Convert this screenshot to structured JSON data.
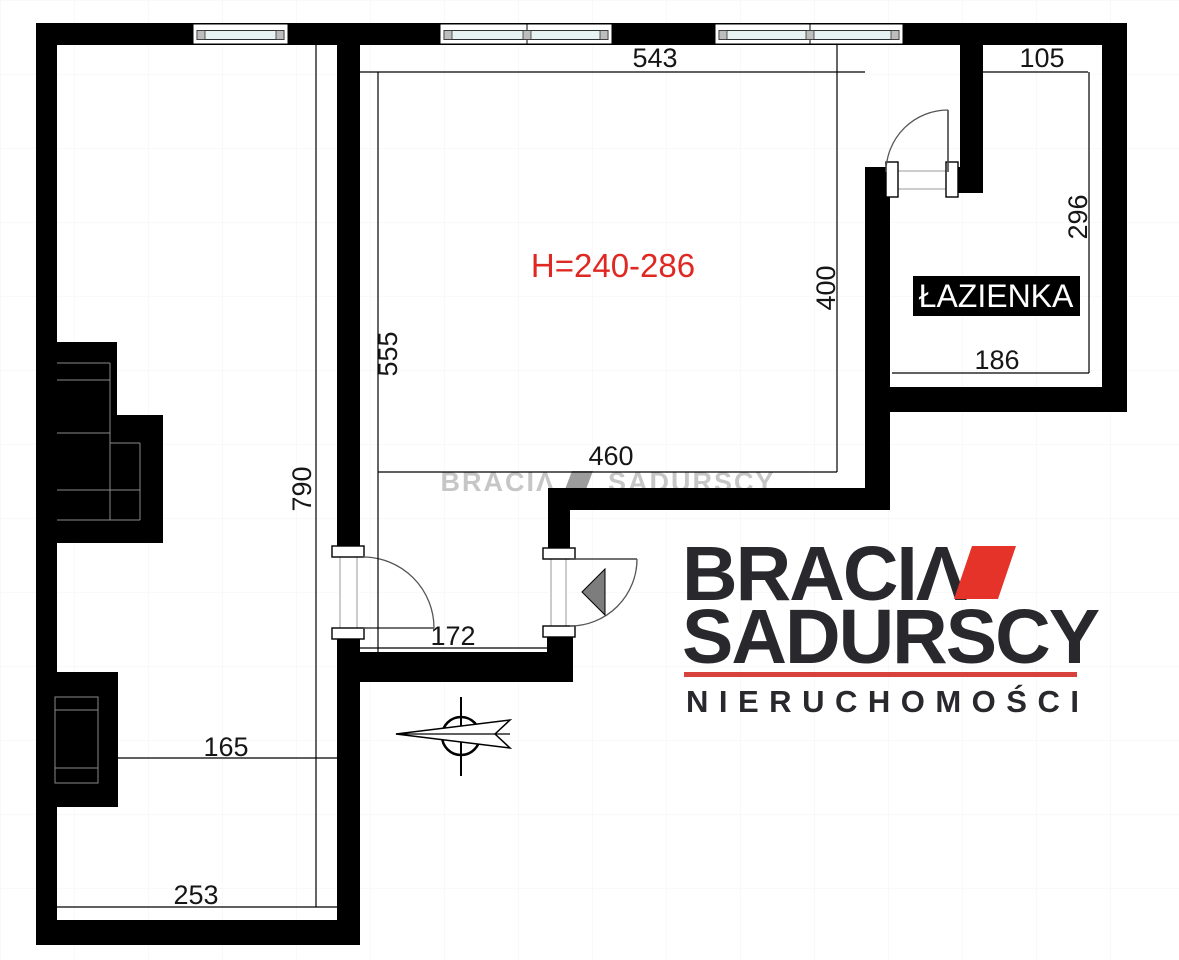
{
  "floor_plan": {
    "height_note": "H=240-286",
    "bathroom_label": "ŁAZIENKA",
    "dimensions": {
      "main_top": "543",
      "bath_top": "105",
      "main_left": "555",
      "main_right": "400",
      "main_bottom": "460",
      "bath_right": "296",
      "bath_bottom": "186",
      "corridor_left": "790",
      "entry_width": "172",
      "lower_room_width": "165",
      "lower_room_bottom": "253"
    }
  },
  "watermark": {
    "word1": "BRACIΛ",
    "word2": "SADURSCY"
  },
  "logo": {
    "word1": "BRACIΛ",
    "word2": "SADURSCY",
    "tagline": "NIERUCHOMOŚCI"
  },
  "colors": {
    "wall": "#000000",
    "brand_red": "#e63329",
    "underline_red": "#d8423c",
    "height_text_red": "#e02822",
    "logo_text": "#29282c",
    "watermark_gray": "#c6c6c6",
    "watermark_mark_gray": "#9c9c9c",
    "glass": "#e7f3f3",
    "mullion_gray": "#bdbdbd",
    "arrow_gray": "#7d7d7d"
  }
}
